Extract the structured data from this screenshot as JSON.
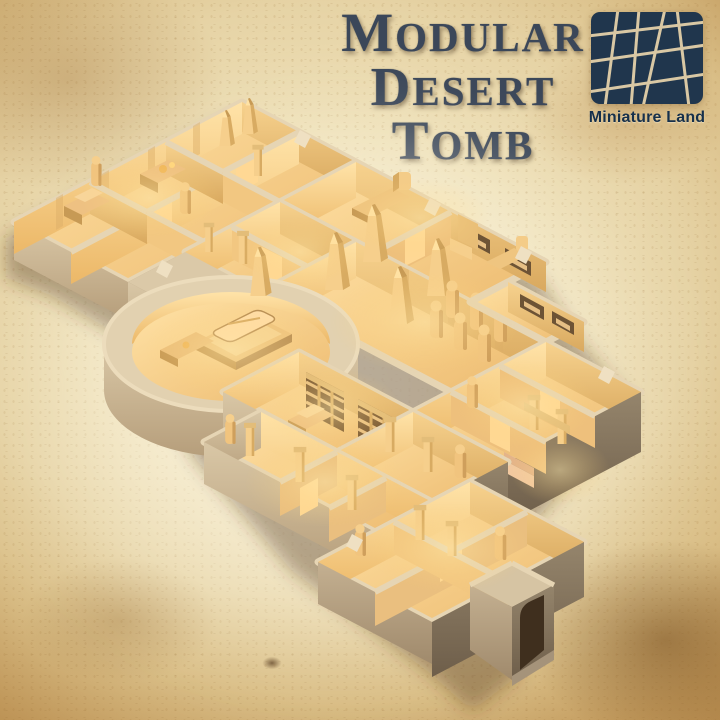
{
  "poster": {
    "title": {
      "line1": "Modular",
      "line2": "Desert",
      "line3": "Tomb"
    },
    "brand": {
      "name": "Miniature Land"
    },
    "scene": {
      "alt": "Isometric 3D render of a sand-colored modular Egyptian desert tomb dungeon with altar rooms, sphinx and throne rooms, obelisk hall, mummy niches, round sarcophagus chamber, library shelves, glowing side rooms and an entrance gate"
    },
    "colors": {
      "title_text": "#3b4759",
      "logo_background": "#20364d",
      "logo_lines": "#d9c8a4",
      "logo_text": "#16304b",
      "parchment_light": "#f4ead0",
      "parchment_dark": "#b68a4e",
      "stone_top": "#e6d5b4",
      "stone_outer_light": "#cdb997",
      "stone_outer_dark": "#6e5e4a",
      "floor_lit": "#ffdf9f",
      "wall_lit": "#ffe3a8"
    }
  }
}
